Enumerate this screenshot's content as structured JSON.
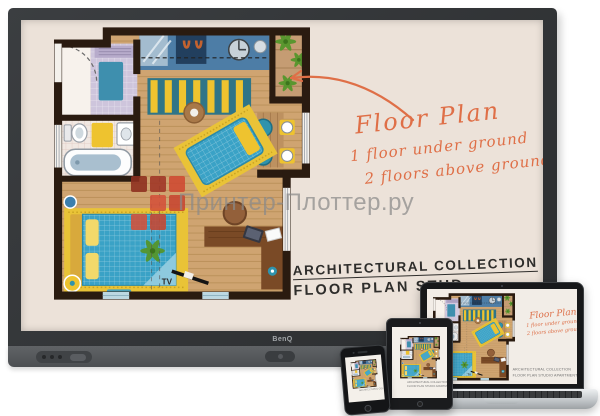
{
  "display": {
    "brand": "BenQ"
  },
  "screen": {
    "annotation": {
      "title": "Floor Plan",
      "line1": "1 floor under ground",
      "line2": "2 floors above ground",
      "color": "#DF6F47"
    },
    "caption": {
      "line1": "ARCHITECTURAL COLLECTION",
      "line2": "FLOOR PLAN STUD",
      "color": "#2E2D2B"
    }
  },
  "floor_plan": {
    "tv_label": "TV"
  },
  "watermark": {
    "text": "Принтер-Плоттер.ру",
    "text_color": "#8A8A8A",
    "logo_colors": [
      "#8E2F1F",
      "#B03A28",
      "#C84631",
      "#D4513A"
    ]
  },
  "laptop": {
    "annotation": {
      "title": "Floor Plan",
      "line1": "1 floor under ground",
      "line2": "2 floors above ground"
    },
    "caption": {
      "line1": "ARCHITECTURAL COLLECTION",
      "line2": "FLOOR PLAN STUDIO APARTMENT"
    }
  },
  "tablet": {
    "caption": {
      "line1": "ARCHITECTURAL COLLECTION",
      "line2": "FLOOR PLAN STUDIO APARTMENT"
    }
  },
  "phone": {
    "caption": "ARCHITECTURAL COLLECTION"
  }
}
